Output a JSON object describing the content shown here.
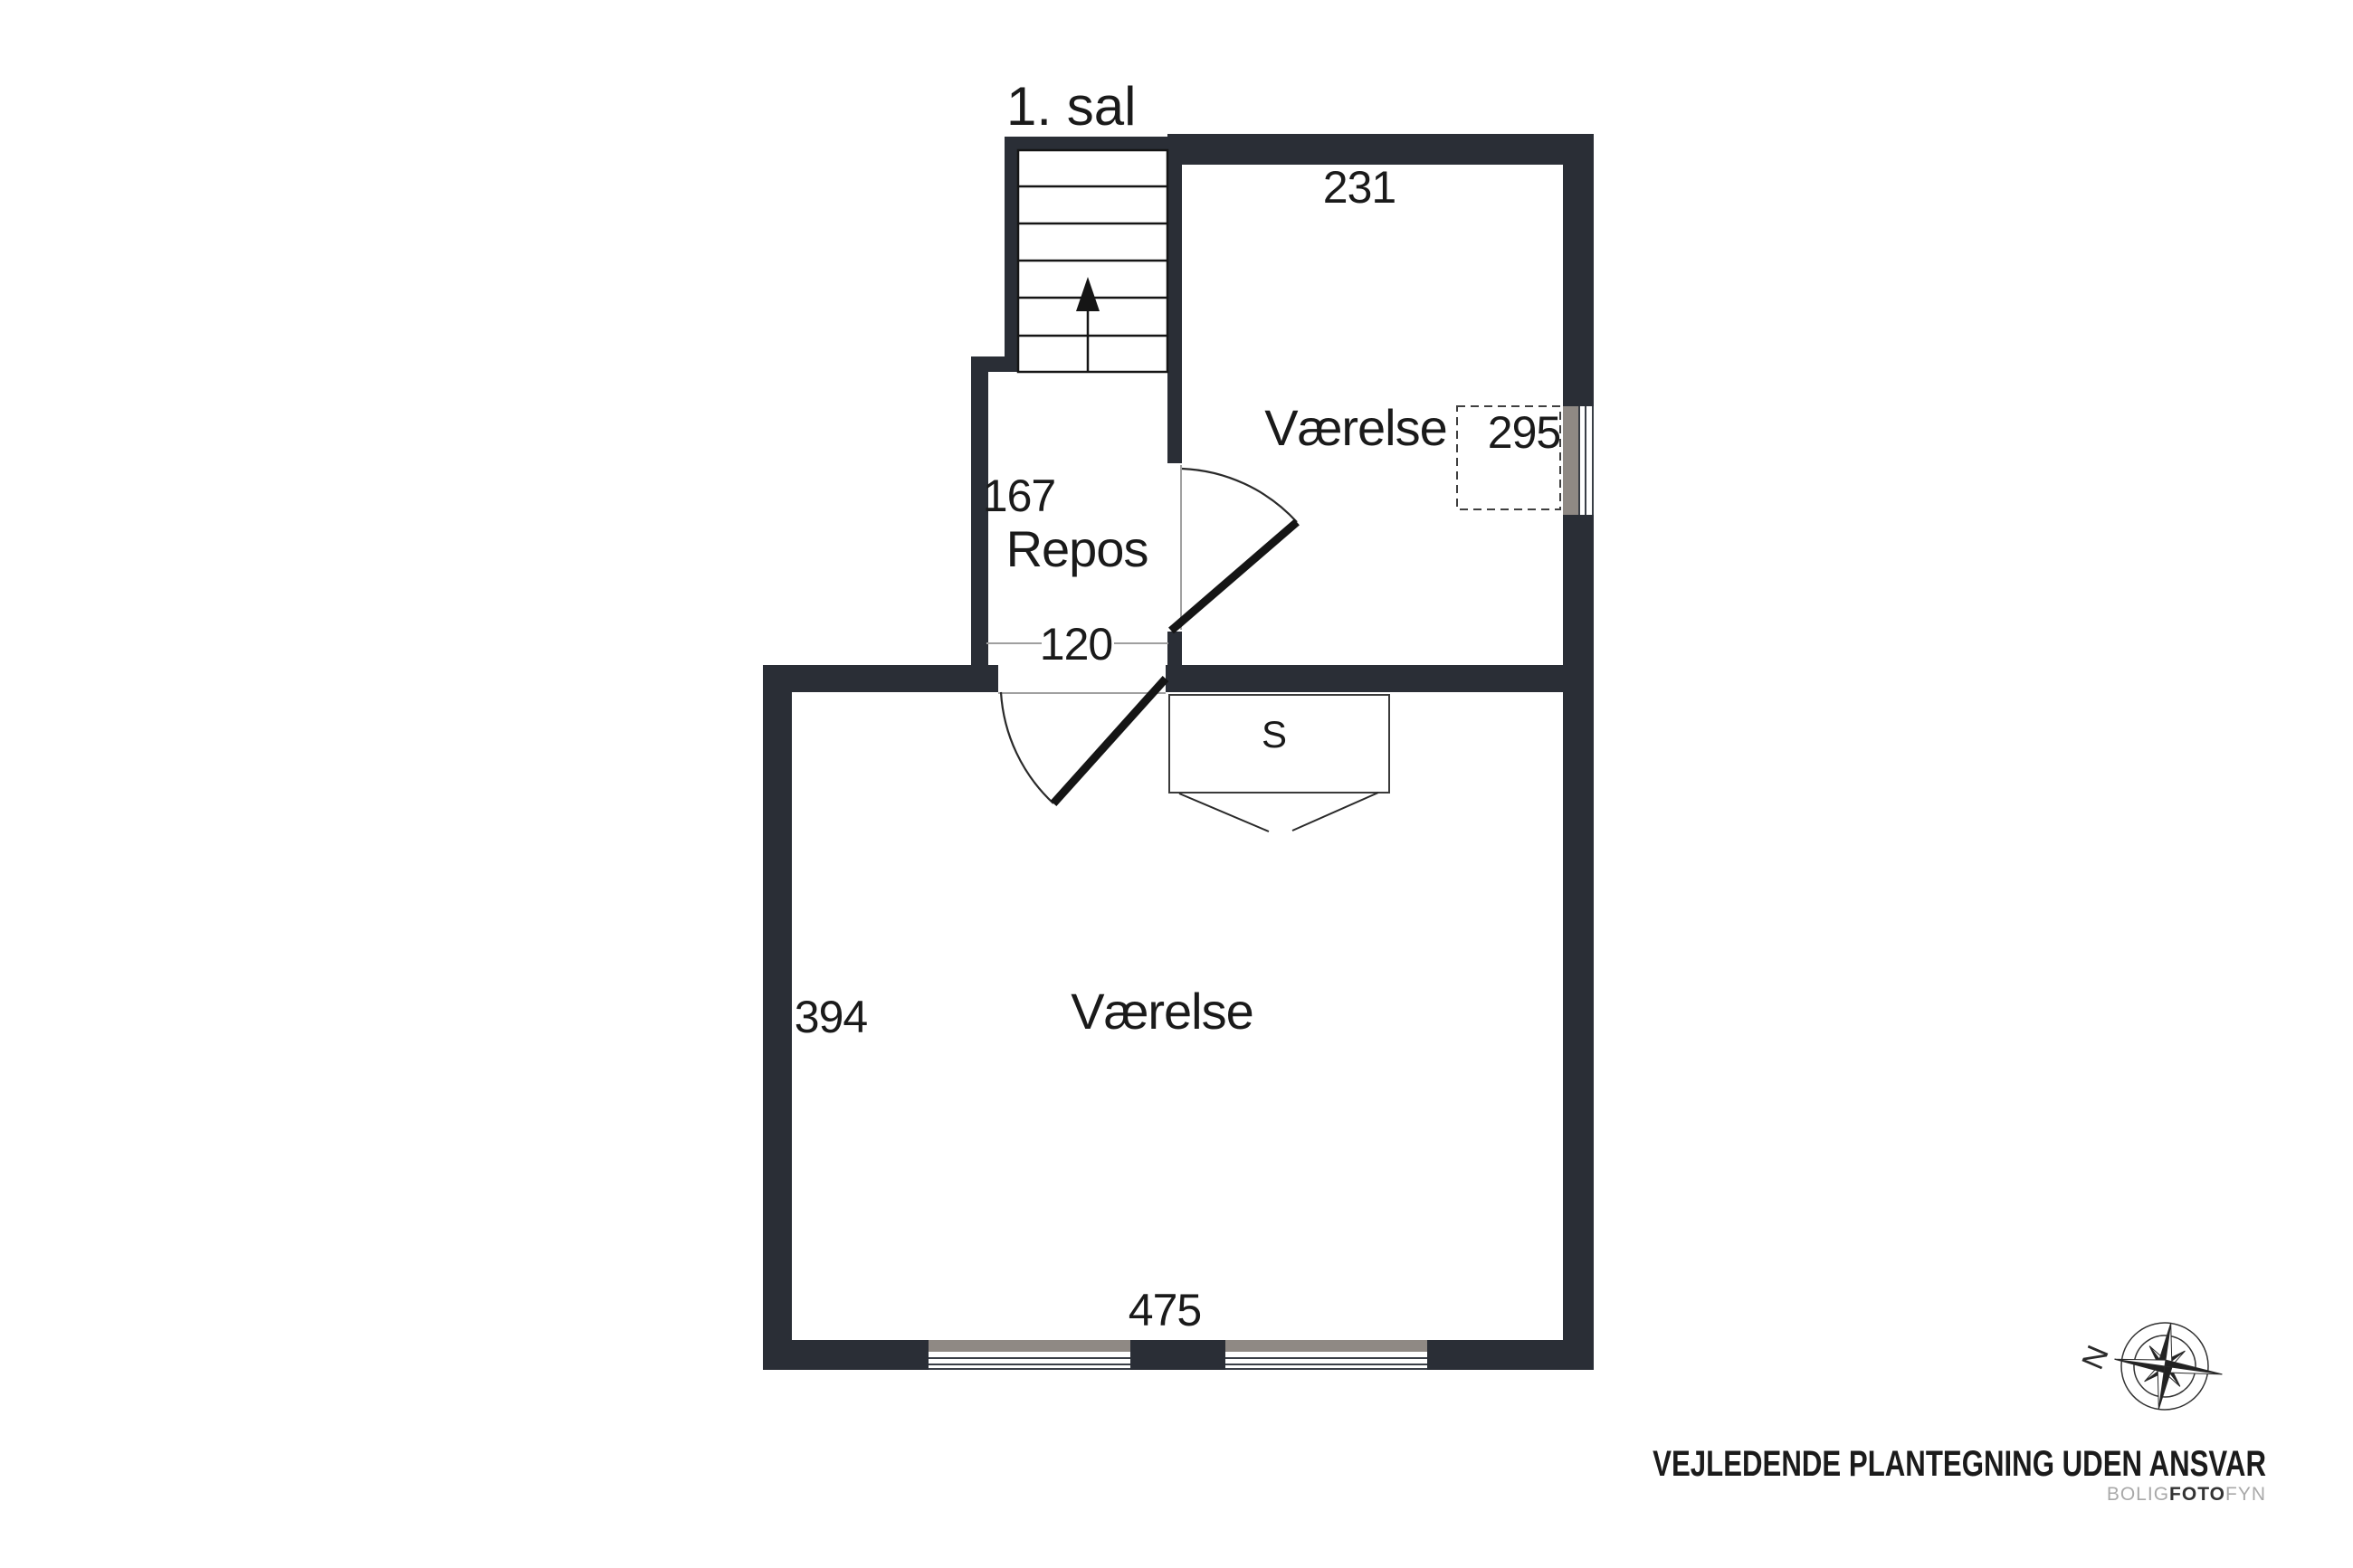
{
  "title": "1. sal",
  "floor_plan": {
    "room_top": {
      "name": "Værelse",
      "top_dim": "231",
      "side_dim": "295"
    },
    "landing": {
      "name": "Repos",
      "side_dim": "167",
      "opening_dim": "120"
    },
    "room_bottom": {
      "name": "Værelse",
      "side_dim": "394",
      "bottom_dim": "475"
    },
    "wardrobe": {
      "label": "S"
    }
  },
  "compass": {
    "north_label": "N"
  },
  "footer": {
    "disclaimer": "VEJLEDENDE PLANTEGNING UDEN ANSVAR",
    "brand": {
      "prefix": "BOLIG",
      "middle": "FOTO",
      "suffix": "FYN"
    }
  },
  "icons": {
    "compass": "compass-rose-icon",
    "stairs_direction": "up-arrow-icon"
  },
  "colors": {
    "wall": "#2a2e36",
    "window_gray": "#8f8984",
    "dimension_line": "#9f9f9f",
    "text": "#1a1a1a",
    "brand_gray": "#a9a9a9",
    "brand_dark": "#333333"
  }
}
